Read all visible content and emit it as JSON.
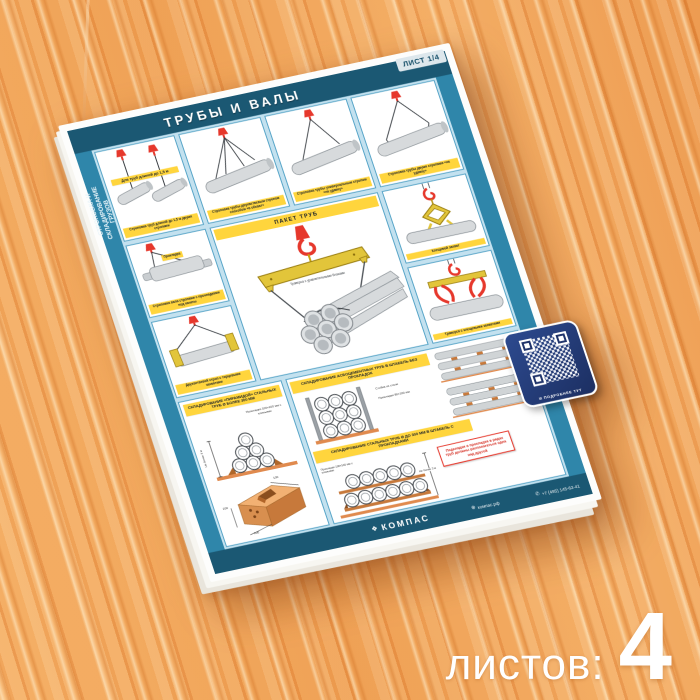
{
  "badge": "ЛИСТ 1/4",
  "title": "ТРУБЫ И ВАЛЫ",
  "side_text": "Строповка и складирование грузов",
  "panels": {
    "short_pipes_label": "Для труб длиной до 1,5 м",
    "short_pipes_caption": "Строповка труб длиной до 1,5 м двумя стропами",
    "four_leg_caption": "Строповка трубы двухветвевым стропом способом «в обхват»",
    "two_leg_caption": "Строповка трубы универсальным стропом «на удавку»",
    "right_sling_caption": "Строповка трубы двумя стропами «на удавку»",
    "shaft_label": "Прокладка",
    "shaft_caption": "Строповка вала стропами с прокладками под канаты",
    "endgrip_caption": "Двухветвевой строп с торцевыми захватами",
    "pincer_caption": "Клещевой захват",
    "traverse_grips_caption": "Траверса с клещевыми захватами",
    "pack_header": "ПАКЕТ ТРУБ",
    "pack_note": "Траверса с уравнительными блоками"
  },
  "storage": {
    "pyramid_header": "СКЛАДИРОВАНИЕ «ПИРАМИДОЙ» СТАЛЬНЫХ ТРУБ Ø БОЛЕЕ 300 мм",
    "steel_header": "СКЛАДИРОВАНИЕ СТАЛЬНЫХ ТРУБ Ø ДО 300 мм В ШТАБЕЛЬ С ПРОКЛАДКАМИ",
    "asbestos_header": "СКЛАДИРОВАНИЕ АСБОЦЕМЕНТНЫХ ТРУБ В ШТАБЕЛЬ БЕЗ ПРОКЛАДОК",
    "pyramid_height": "Не более 3 м",
    "steel_height": "Не более 3 м",
    "pyramid_spacers": "Прокладки 100×100 мм с клиньями",
    "steel_spacers": "Прокладки 100×100 мм с клиньями",
    "asbestos_stand": "Стойка из стали",
    "asbestos_spacers": "Прокладки 80×100 мм",
    "warning": "Подкладки и прокладки в рядах труб должны располагаться одна над другой",
    "block_dims": {
      "w": "100",
      "d": "100",
      "h": "200"
    }
  },
  "footer": {
    "brand": "КОМПАС",
    "site": "компас.рф",
    "phone": "+7 (495) 145-62-41"
  },
  "qr_caption": "И ПОДРОБНЕЕ ТУТ",
  "overlay": {
    "sheets_label": "листов:",
    "sheets_count": "4"
  },
  "colors": {
    "teal": "#2f86aa",
    "dark_teal": "#1b5873",
    "light_blue": "#c3e1ef",
    "yellow": "#ffd53d",
    "red": "#e6382c",
    "navy": "#1c2f62",
    "wood": "#eda05c"
  }
}
